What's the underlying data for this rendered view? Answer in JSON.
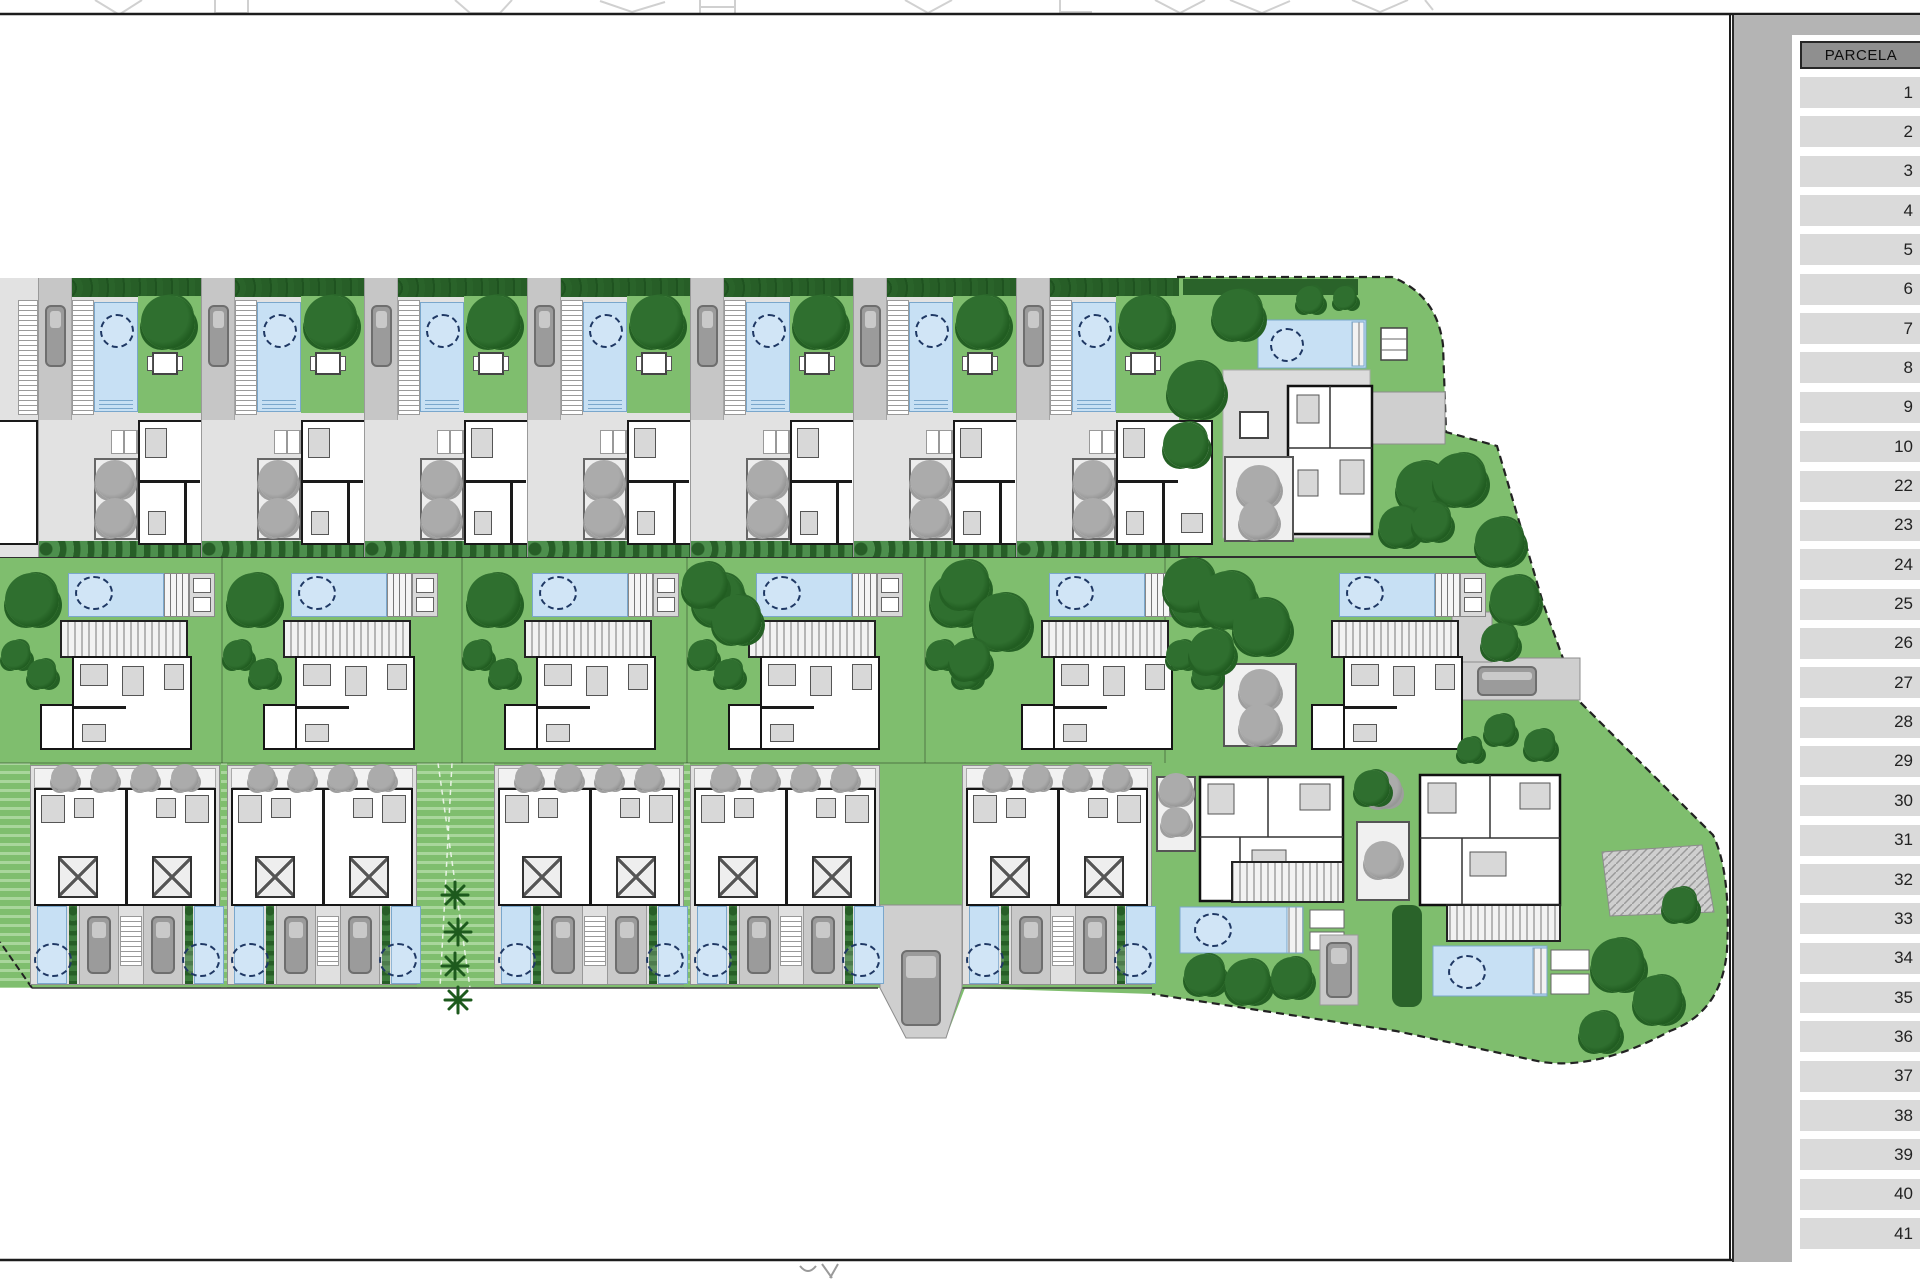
{
  "table": {
    "header": "PARCELA",
    "rows": [
      "1",
      "2",
      "3",
      "4",
      "5",
      "6",
      "7",
      "8",
      "9",
      "10",
      "22",
      "23",
      "24",
      "25",
      "26",
      "27",
      "28",
      "29",
      "30",
      "31",
      "32",
      "33",
      "34",
      "35",
      "36",
      "37",
      "38",
      "39",
      "40",
      "41"
    ]
  },
  "plan": {
    "top_row_labels": [
      "8",
      "7",
      "6",
      "5",
      "4",
      "3",
      "2"
    ],
    "villa_one_label": "1",
    "middle_row_labels": [
      "25",
      "27",
      "31",
      "33",
      "37",
      "41"
    ],
    "bottom_row_labels": [
      [
        "24",
        "26"
      ],
      [
        "28",
        "29"
      ],
      [
        "30",
        "32"
      ],
      [
        "34",
        "35"
      ],
      [
        "36",
        "38"
      ]
    ],
    "villa_39_label": "39",
    "villa_40_label": "40"
  },
  "colors": {
    "lawn": "#7fbe6e",
    "pool": "#c7e0f4",
    "tree_dark": "#215d21",
    "panel": "#b4b4b4",
    "header_cell": "#8f8f8f",
    "row_cell": "#dadada"
  }
}
